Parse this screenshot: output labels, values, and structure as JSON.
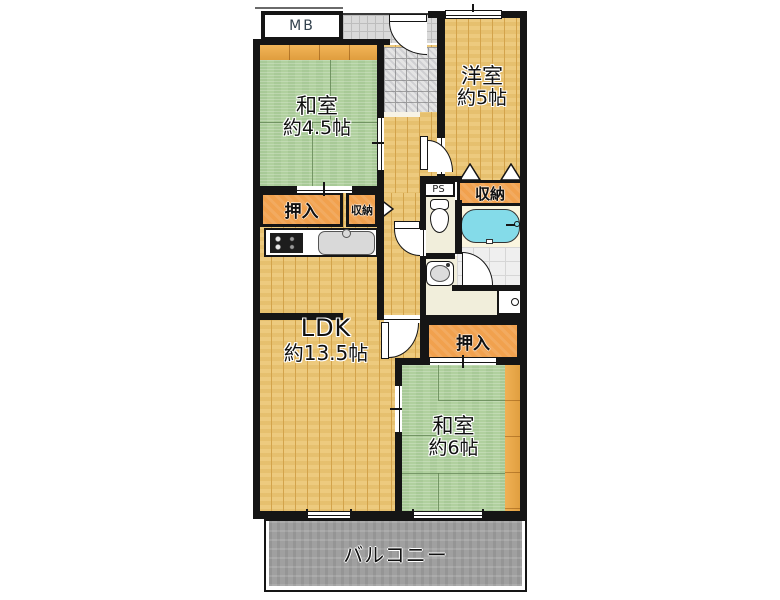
{
  "rooms": {
    "washitsu_45": {
      "name": "和室",
      "size": "約4.5帖"
    },
    "youshitsu_5": {
      "name": "洋室",
      "size": "約5帖"
    },
    "ldk": {
      "name": "LDK",
      "size": "約13.5帖"
    },
    "washitsu_6": {
      "name": "和室",
      "size": "約6帖"
    },
    "balcony": {
      "name": "バルコニー"
    }
  },
  "storage": {
    "oshiire_top": "押入",
    "shuunou_hall": "収納",
    "shuunou_bath": "収納",
    "oshiire_bottom": "押入"
  },
  "utility": {
    "meter_box": "MB",
    "pipe_space": "PS"
  },
  "colors": {
    "wall": "#151515",
    "tatami_green": "#b0d09e",
    "wood_floor": "#ecc674",
    "closet_orange": "#f1a14e",
    "balcony_gray": "#a0a0a0",
    "bathtub_cyan": "#84dbe9",
    "washroom_floor": "#f1eedb",
    "porch_tile": "#d9d9d9"
  }
}
